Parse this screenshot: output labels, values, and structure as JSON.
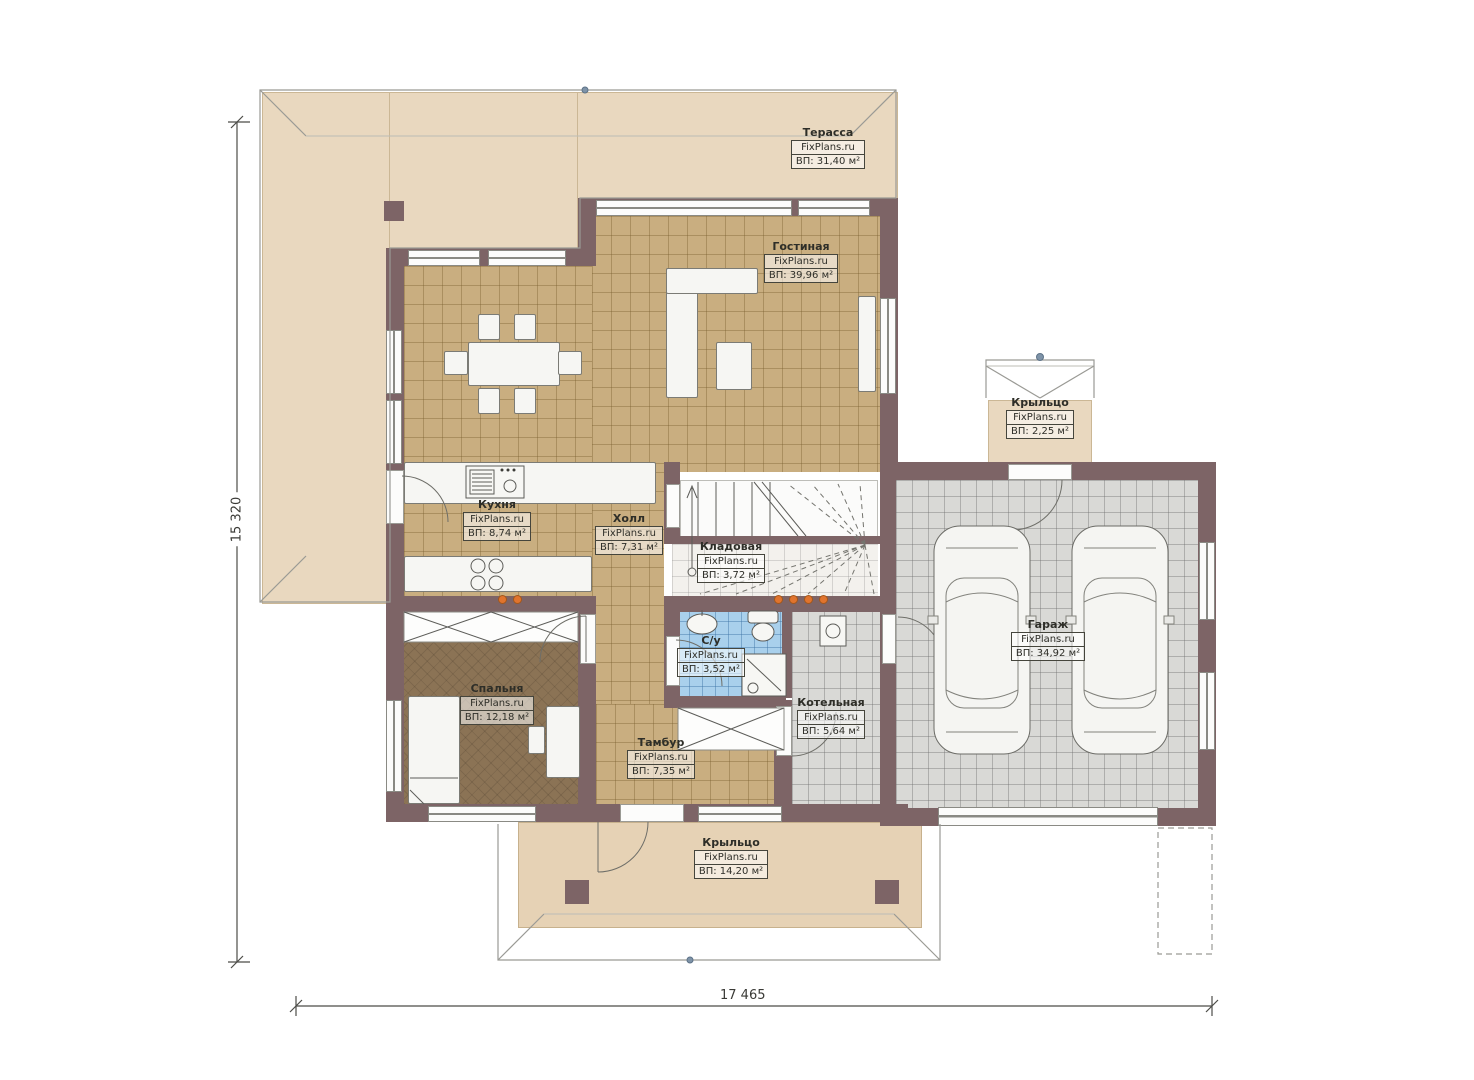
{
  "plan": {
    "watermark": "FixPlans.ru",
    "rooms": [
      {
        "id": "terrace",
        "name": "Терасса",
        "area": "ВП: 31,40 м²"
      },
      {
        "id": "living",
        "name": "Гостиная",
        "area": "ВП: 39,96 м²"
      },
      {
        "id": "porch-top",
        "name": "Крыльцо",
        "area": "ВП: 2,25 м²"
      },
      {
        "id": "kitchen",
        "name": "Кухня",
        "area": "ВП: 8,74 м²"
      },
      {
        "id": "hall",
        "name": "Холл",
        "area": "ВП: 7,31 м²"
      },
      {
        "id": "pantry",
        "name": "Кладовая",
        "area": "ВП: 3,72 м²"
      },
      {
        "id": "garage",
        "name": "Гараж",
        "area": "ВП: 34,92 м²"
      },
      {
        "id": "bathroom",
        "name": "С/у",
        "area": "ВП: 3,52 м²"
      },
      {
        "id": "boiler",
        "name": "Котельная",
        "area": "ВП: 5,64 м²"
      },
      {
        "id": "bedroom",
        "name": "Спальня",
        "area": "ВП: 12,18 м²"
      },
      {
        "id": "vestibule",
        "name": "Тамбур",
        "area": "ВП: 7,35 м²"
      },
      {
        "id": "porch-bottom",
        "name": "Крыльцо",
        "area": "ВП: 14,20 м²"
      }
    ],
    "dimensions": {
      "width_label": "17 465",
      "height_label": "15 320"
    },
    "colors": {
      "wall": "#7d6466",
      "floor_tan": "#c9ae80",
      "floor_gray": "#d9d9d6",
      "floor_blue": "#a9d0ec",
      "floor_bedroom": "#8b7355",
      "terrace_beige": "#e9d8bf",
      "accent_orange": "#e0742e"
    }
  }
}
